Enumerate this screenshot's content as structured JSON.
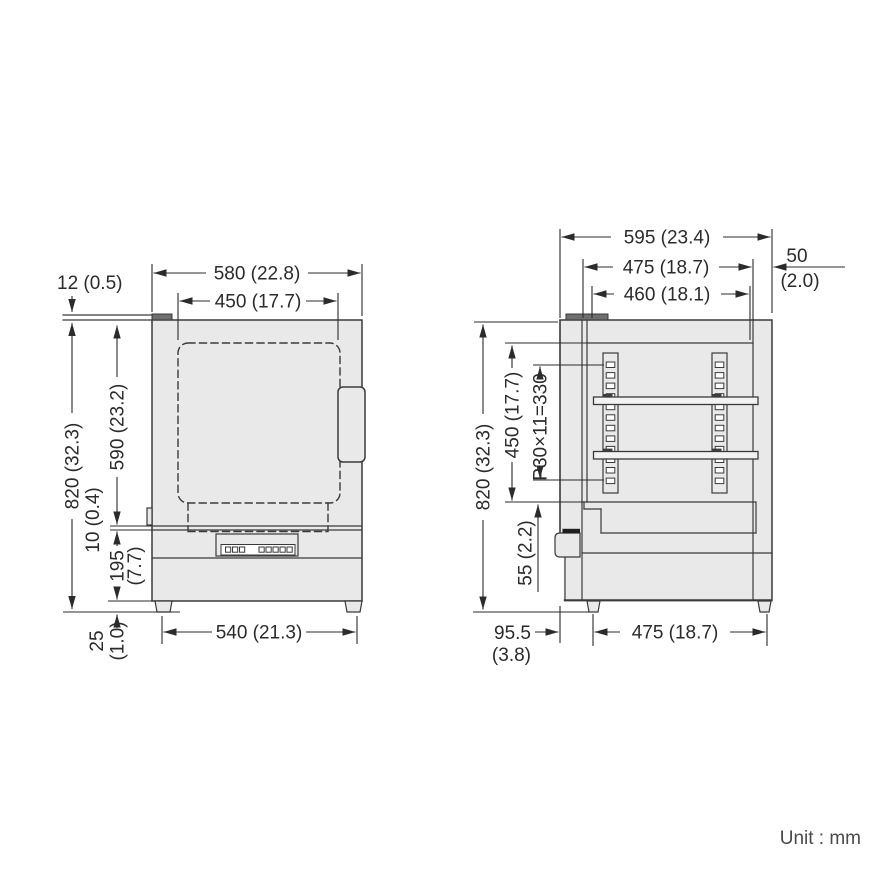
{
  "unit_label": "Unit : mm",
  "colors": {
    "line": "#3a3a3a",
    "dim": "#2b2b2b",
    "body_fill": "#e9e9e9",
    "shelf_fill": "#f2f2f2",
    "tab_fill": "#6f6f6f",
    "latch_fill": "#1f1f1f",
    "note": "#4a4a4a"
  },
  "front_view": {
    "dim_top_plate": "12 (0.5)",
    "dim_outer_width": "580 (22.8)",
    "dim_inner_width": "450 (17.7)",
    "dim_total_height": "820 (32.3)",
    "dim_upper_height": "590 (23.2)",
    "dim_gap": "10 (0.4)",
    "dim_base_height": "195",
    "dim_base_height_in": "(7.7)",
    "dim_foot_height": "25",
    "dim_foot_height_in": "(1.0)",
    "dim_foot_span": "540 (21.3)"
  },
  "side_view": {
    "dim_outer_depth": "595 (23.4)",
    "dim_chamber_depth": "475 (18.7)",
    "dim_inner_depth": "460 (18.1)",
    "dim_rear_clearance": "50",
    "dim_rear_clearance_in": "(2.0)",
    "dim_total_height": "820 (32.3)",
    "dim_chamber_height": "450 (17.7)",
    "dim_shelf_pitch": "P30×11=330",
    "dim_floor_offset": "55 (2.2)",
    "dim_front_foot_offset": "95.5",
    "dim_front_foot_offset_in": "(3.8)",
    "dim_foot_span": "475 (18.7)"
  }
}
